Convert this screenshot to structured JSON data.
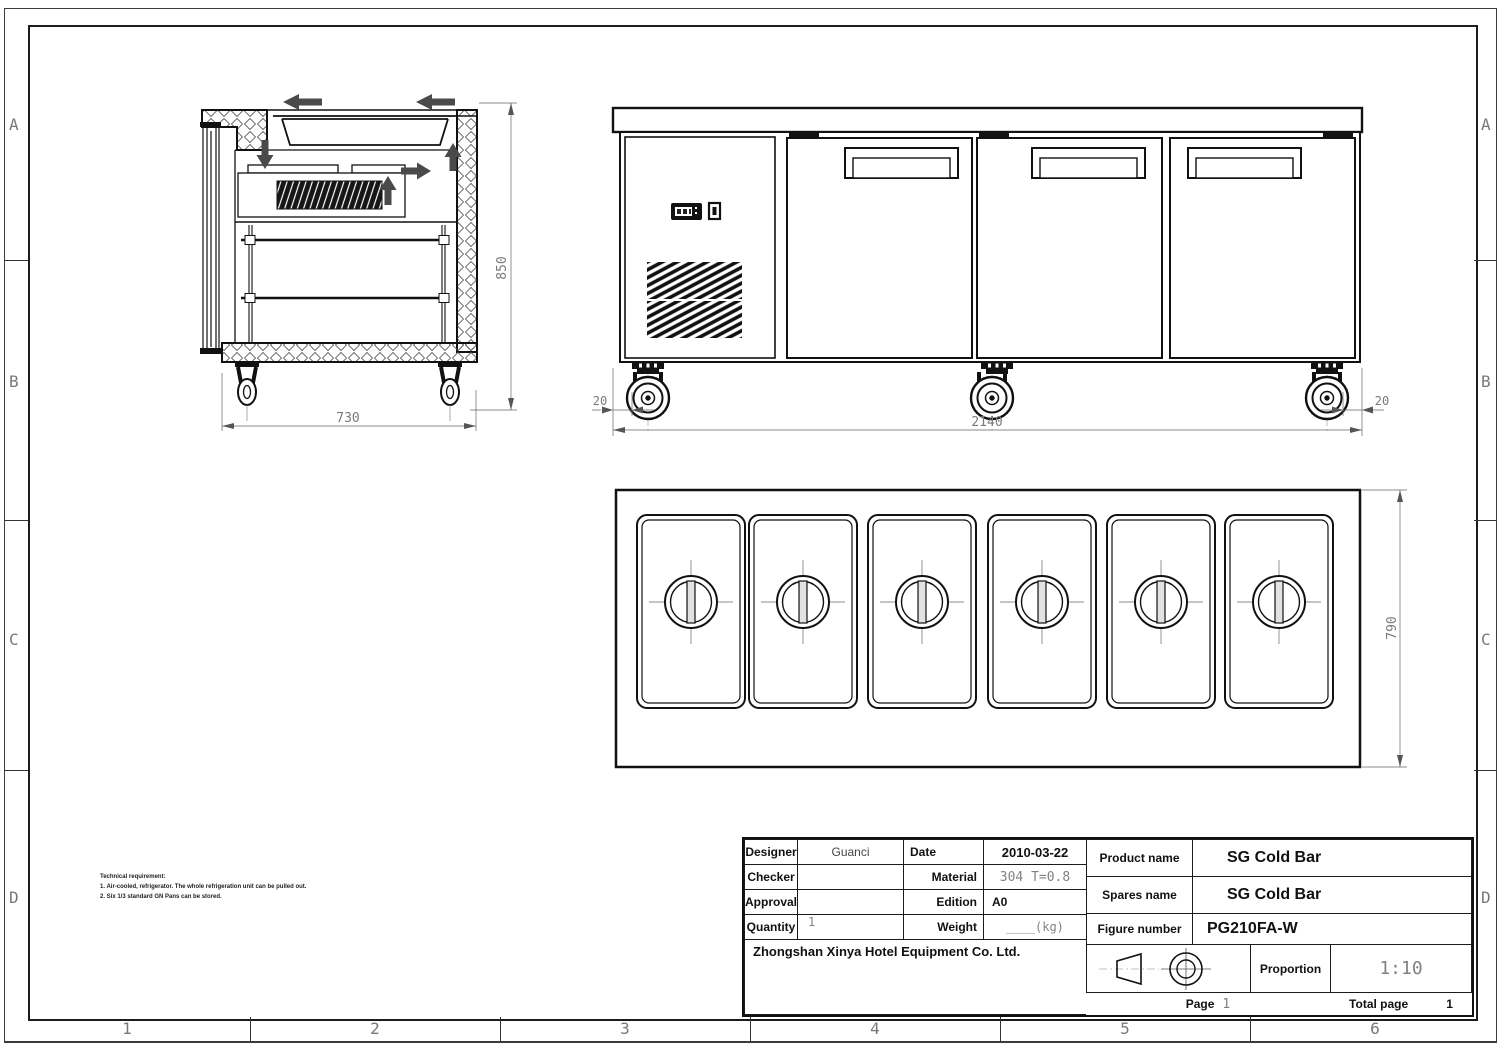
{
  "frame": {
    "rows": [
      "A",
      "B",
      "C",
      "D"
    ],
    "cols": [
      "1",
      "2",
      "3",
      "4",
      "5",
      "6"
    ]
  },
  "notes": {
    "title": "Technical requirement:",
    "items": [
      "1. Air-cooled, refrigerator. The whole refrigeration unit can be pulled out.",
      "2. Six 1/3 standard GN Pans can be stored."
    ]
  },
  "dims": {
    "side_depth": "730",
    "side_height": "850",
    "front_width": "2140",
    "front_left_offset": "20",
    "front_right_offset": "20",
    "top_depth": "790"
  },
  "title_block": {
    "designer_label": "Designer",
    "designer_value": "Guanci",
    "date_label": "Date",
    "date_value": "2010-03-22",
    "checker_label": "Checker",
    "checker_value": "",
    "material_label": "Material",
    "material_value": "304 T=0.8",
    "approval_label": "Approval",
    "approval_value": "",
    "edition_label": "Edition",
    "edition_value": "A0",
    "quantity_label": "Quantity",
    "quantity_value": "1",
    "weight_label": "Weight",
    "weight_value": "____(kg)",
    "company": "Zhongshan Xinya Hotel Equipment Co. Ltd.",
    "product_name_label": "Product name",
    "product_name_value": "SG Cold Bar",
    "spares_name_label": "Spares name",
    "spares_name_value": "SG Cold Bar",
    "figure_number_label": "Figure number",
    "figure_number_value": "PG210FA-W",
    "proportion_label": "Proportion",
    "proportion_value": "1:10",
    "page_label": "Page",
    "page_value": "1",
    "total_page_label": "Total page",
    "total_page_value": "1"
  }
}
